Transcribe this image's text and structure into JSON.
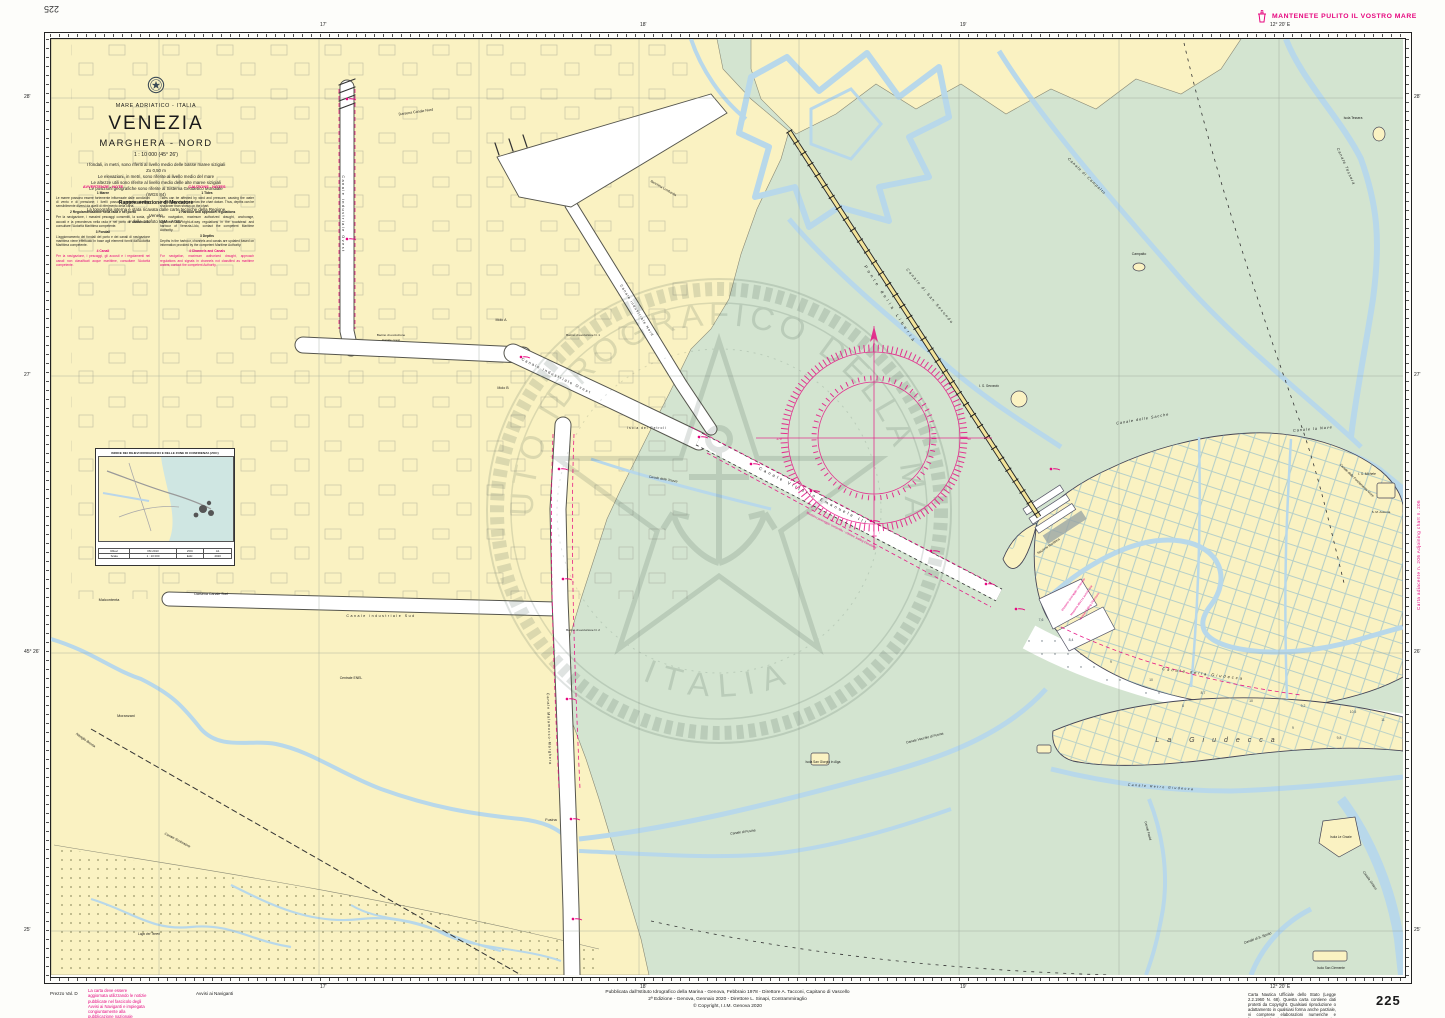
{
  "page": {
    "chart_number": "225",
    "corner_number": "225",
    "slogan": "MANTENETE PULITO IL VOSTRO MARE",
    "adjoining": "Carta adiacente n. 206        Adjoining chart n. 206",
    "bottom_left": {
      "price": "Prezzo Val. D",
      "update_note": "La carta deve essere aggiornata utilizzando le notizie pubblicate nel fascicolo degli Avvisi ai Naviganti e impiegata congiuntamente alla pubblicazione nazionale relativa.",
      "notices": "Avvisi ai Naviganti"
    },
    "bottom_center": {
      "line1": "Pubblicata dall'Istituto Idrografico della Marina - Genova, Febbraio 1978 - Direttore A. Tacconi, Capitano di Vascello",
      "line2": "2ª Edizione - Genova, Gennaio 2020 - Direttore L. Sinapi, Contrammiraglio",
      "line3": "© Copyright, I.I.M. Genova 2020"
    },
    "bottom_right_legal": "Carta Nautica Ufficiale dello Stato (Legge 2.2.1960 N. 68). Questa carta contiene dati protetti da Copyright. Qualsiasi riproduzione o adattamento in qualsiasi forma anche parziale, vi comprese elaborazioni numeriche e fotocopie, è vietata senza una preventiva autorizzazione scritta da parte dell'Istituto Idrografico della Marina.",
    "margins": {
      "top": [
        {
          "x": 320,
          "t": "17'"
        },
        {
          "x": 640,
          "t": "18'"
        },
        {
          "x": 960,
          "t": "19'"
        },
        {
          "x": 1270,
          "t": "12° 20' E"
        }
      ],
      "bottom": [
        {
          "x": 320,
          "t": "17'"
        },
        {
          "x": 640,
          "t": "18'"
        },
        {
          "x": 960,
          "t": "19'"
        },
        {
          "x": 1270,
          "t": "12° 20' E"
        }
      ],
      "left": [
        {
          "y": 97,
          "t": "28'"
        },
        {
          "y": 375,
          "t": "27'"
        },
        {
          "y": 652,
          "t": "45° 26'"
        },
        {
          "y": 930,
          "t": "25'"
        }
      ],
      "right": [
        {
          "y": 97,
          "t": "28'"
        },
        {
          "y": 375,
          "t": "27'"
        },
        {
          "y": 652,
          "t": "26'"
        },
        {
          "y": 930,
          "t": "25'"
        }
      ]
    }
  },
  "title_block": {
    "lines": [
      "MARE ADRIATICO - ITALIA",
      "VENEZIA",
      "MARGHERA - NORD",
      "1 : 10 000 (45° 26')",
      "I fondali, in metri, sono riferiti al livello medio delle basse maree sizigiali",
      "Zo 0,50 m",
      "Le elevazioni, in metri, sono riferite al livello medio del mare",
      "Le altezze utili sono riferite al livello medio delle alte maree sizigiali",
      "Le posizioni geografiche sono riferite al Sistema Geodetico Mondiale (WGS 84)",
      "Rappresentazione di Mercatore",
      "La topografia interna è stata ricavata dalle carte tecniche della Regione Veneto",
      "e dalle ortofoto IGM - AGEA"
    ]
  },
  "notes": {
    "it": {
      "header": "AVVERTENZE - NOTE",
      "s1h": "1  Maree",
      "s1b": "Le maree possono essere fortemente influenzate dalle condizioni di vento e di pressione; i livelli possono pertanto risultare sensibilmente diversi da quelli di riferimento della carta.",
      "s2h": "2  Regolamentazione nella rada e nel porto",
      "s2b": "Per la navigazione, i massimi pescaggi consentiti, la sosta, gli accosti e la precedenza nella rada e nel porto di Venezia-Lido consultare l'Autorità Marittima competente.",
      "s3h": "3  Fondali",
      "s3b": "L'aggiornamento dei fondali del porto e dei canali di navigazione marittima viene effettuato in base agli elementi forniti dall'Autorità Marittima competente.",
      "s4h": "4  Canali",
      "s4b": "Per la navigazione, i pescaggi, gli accosti e i regolamenti nei canali non classificati acque marittime, consultare l'Autorità competente."
    },
    "en": {
      "header": "CAUTIONS - NOTES",
      "s1h": "1  Tides",
      "s1b": "Tides can be affected by wind and pressure, causing the water level to stay above or below the chart datum. Thus, depths can be shallower than shown on the chart.",
      "s2h": "2  Harbour and approach regulations",
      "s2b": "For navigation, maximum authorized draught, anchorage, approach and right-of-way regulations in the roadstead and harbour of Venezia-Lido, contact the competent Maritime Authority.",
      "s3h": "3  Depths",
      "s3b": "Depths in the harbour, channels and canals are updated based on information provided by the competent Maritime Authority.",
      "s4h": "4  Channels and Canals",
      "s4b": "For navigation, maximum authorized draught, approach regulations and signals in channels not classified as maritime waters, contact the competent Authority."
    }
  },
  "inset": {
    "title": "INDICE DEI RILIEVI IDROGRAFICI E DELLE ZONE DI CONFIDENZA (ZOC)",
    "table": [
      [
        "Rilievi",
        "IIM 2013",
        "ZOC",
        "A1"
      ],
      [
        "Scala",
        "1 : 10 000",
        "Ediz.",
        "2020"
      ]
    ]
  },
  "map": {
    "colors": {
      "magenta": "#E6067E",
      "land": "#FAF2C2",
      "lagoon": "#D3E4D0",
      "water": "#B8D8EA"
    },
    "watermark": {
      "text_top": "ISTITUTO IDROGRAFICO DELLA MARINA",
      "text_bottom": "ITALIA"
    },
    "labels": [
      {
        "t": "Darsena Canale Nord",
        "x": 365,
        "y": 74,
        "s": 3.6,
        "r": -8
      },
      {
        "t": "Canale industriale Ovest",
        "x": 291,
        "y": 175,
        "s": 3.8,
        "r": 90,
        "sp": 1.5
      },
      {
        "t": "Canale industriale Ovest",
        "x": 505,
        "y": 338,
        "s": 3.8,
        "r": 26,
        "sp": 1.5
      },
      {
        "t": "Canale industriale Nord",
        "x": 585,
        "y": 272,
        "s": 3.6,
        "r": 58,
        "sp": 1
      },
      {
        "t": "Bacino di evoluzione",
        "x": 340,
        "y": 297,
        "s": 3.1
      },
      {
        "t": "Canale ovest",
        "x": 340,
        "y": 302,
        "s": 3.1
      },
      {
        "t": "Molo A",
        "x": 450,
        "y": 282,
        "s": 3.6
      },
      {
        "t": "Molo B",
        "x": 452,
        "y": 350,
        "s": 3.6
      },
      {
        "t": "Banchina Lombardia",
        "x": 612,
        "y": 150,
        "s": 3.2,
        "r": 30
      },
      {
        "t": "Darsena Canale Sud",
        "x": 160,
        "y": 556,
        "s": 3.6
      },
      {
        "t": "Canale industriale Sud",
        "x": 330,
        "y": 578,
        "s": 3.6,
        "sp": 1.5
      },
      {
        "t": "Bacino di evoluzione N. 1",
        "x": 532,
        "y": 297,
        "s": 3
      },
      {
        "t": "Bacino di evoluzione N. 2",
        "x": 532,
        "y": 592,
        "s": 3
      },
      {
        "t": "Canale Malamocco-Marghera",
        "x": 497,
        "y": 690,
        "s": 3.6,
        "r": 88,
        "sp": 1
      },
      {
        "t": "Isola dei Petroli",
        "x": 596,
        "y": 390,
        "s": 3.3,
        "sp": 1
      },
      {
        "t": "Canale delle Trezze",
        "x": 612,
        "y": 441,
        "s": 3.3,
        "r": 10,
        "i": 1
      },
      {
        "t": "Canale Vittorio Emanuele III",
        "x": 762,
        "y": 458,
        "s": 4.2,
        "r": 27,
        "sp": 2.5
      },
      {
        "t": "Massimo pescaggio consentito - vds/see Sailing Directions",
        "x": 790,
        "y": 492,
        "s": 3,
        "r": 27,
        "c": "m"
      },
      {
        "t": "Ponte della Libertà",
        "x": 838,
        "y": 266,
        "s": 4.2,
        "r": 57,
        "sp": 3
      },
      {
        "t": "Canale di San Secondo",
        "x": 878,
        "y": 258,
        "s": 3.8,
        "r": 50,
        "i": 1,
        "sp": 1.5
      },
      {
        "t": "I. S. Secondo",
        "x": 938,
        "y": 348,
        "s": 3.3,
        "i": 1
      },
      {
        "t": "Canale di Campalto",
        "x": 1035,
        "y": 138,
        "s": 3.8,
        "r": 44,
        "i": 1,
        "sp": 1
      },
      {
        "t": "Canale Tessera",
        "x": 1294,
        "y": 128,
        "s": 3.8,
        "r": 66,
        "i": 1,
        "sp": 1
      },
      {
        "t": "Isola Tessera",
        "x": 1302,
        "y": 80,
        "s": 3.2
      },
      {
        "t": "Campalto",
        "x": 1088,
        "y": 216,
        "s": 3.4
      },
      {
        "t": "Canale delle Sacche",
        "x": 1092,
        "y": 381,
        "s": 3.8,
        "r": -10,
        "i": 1,
        "sp": 1
      },
      {
        "t": "Canale la Nave",
        "x": 1262,
        "y": 391,
        "s": 3.8,
        "r": -5,
        "i": 1,
        "sp": 1
      },
      {
        "t": "Canale delle Fondamenta Nove",
        "x": 1305,
        "y": 442,
        "s": 3.3,
        "r": 44,
        "i": 1
      },
      {
        "t": "I. S. Michele",
        "x": 1316,
        "y": 436,
        "s": 3.2,
        "i": 1
      },
      {
        "t": "S. M. Assunta",
        "x": 1330,
        "y": 474,
        "s": 3
      },
      {
        "t": "Stazione Marittima",
        "x": 998,
        "y": 508,
        "s": 3.2,
        "r": -34
      },
      {
        "t": "Massimo pescaggio consentito",
        "x": 1023,
        "y": 556,
        "s": 2.9,
        "r": -55,
        "c": "m"
      },
      {
        "t": "Massima altezza autorizzata",
        "x": 1031,
        "y": 562,
        "s": 2.9,
        "r": -55,
        "c": "m"
      },
      {
        "t": "vds/see Sailing Directions",
        "x": 1039,
        "y": 568,
        "s": 2.9,
        "r": -55,
        "c": "m"
      },
      {
        "t": "Canale della Giudecca",
        "x": 1152,
        "y": 636,
        "s": 4,
        "r": 7,
        "i": 1,
        "sp": 2
      },
      {
        "t": "La Giudecca",
        "x": 1168,
        "y": 703,
        "s": 7,
        "i": 1,
        "sp": 8,
        "c": "#444"
      },
      {
        "t": "Canale Retro Giudecca",
        "x": 1110,
        "y": 749,
        "s": 3.4,
        "r": 4,
        "i": 1,
        "sp": 1.5
      },
      {
        "t": "Canale Fasiol",
        "x": 1096,
        "y": 792,
        "s": 3.2,
        "r": 75,
        "i": 1
      },
      {
        "t": "Isola Le Grazie",
        "x": 1290,
        "y": 799,
        "s": 3.2
      },
      {
        "t": "Canale Orfano",
        "x": 1318,
        "y": 842,
        "s": 3.4,
        "r": 55,
        "i": 1
      },
      {
        "t": "Canale di S. Spirito",
        "x": 1207,
        "y": 900,
        "s": 3.4,
        "r": -20,
        "i": 1
      },
      {
        "t": "Isola San Clemente",
        "x": 1280,
        "y": 930,
        "s": 3.2
      },
      {
        "t": "Isola San Giorgio in Alga",
        "x": 772,
        "y": 724,
        "s": 3.2
      },
      {
        "t": "Canale Vecchio di Fusina",
        "x": 874,
        "y": 700,
        "s": 3.4,
        "r": -14,
        "i": 1
      },
      {
        "t": "Canale di Fusina",
        "x": 692,
        "y": 794,
        "s": 3.4,
        "r": -8,
        "i": 1
      },
      {
        "t": "Fusina",
        "x": 500,
        "y": 782,
        "s": 3.8
      },
      {
        "t": "Malcontenta",
        "x": 58,
        "y": 562,
        "s": 3.8
      },
      {
        "t": "Moranzani",
        "x": 75,
        "y": 678,
        "s": 3.8
      },
      {
        "t": "Centrale ENEL",
        "x": 300,
        "y": 640,
        "s": 3.4
      },
      {
        "t": "Naviglio Brenta",
        "x": 34,
        "y": 702,
        "s": 3.4,
        "r": 35,
        "i": 1
      },
      {
        "t": "Canale Scolmatore",
        "x": 126,
        "y": 802,
        "s": 3.4,
        "r": 28,
        "i": 1
      },
      {
        "t": "Lago dei Teneri",
        "x": 98,
        "y": 896,
        "s": 3.2,
        "i": 1
      },
      {
        "t": "0",
        "x": 823,
        "y": 306,
        "s": 3,
        "c": "m"
      },
      {
        "t": "90",
        "x": 918,
        "y": 401,
        "s": 3,
        "c": "m"
      },
      {
        "t": "180",
        "x": 823,
        "y": 498,
        "s": 3,
        "c": "m"
      },
      {
        "t": "270",
        "x": 728,
        "y": 401,
        "s": 3,
        "c": "m"
      }
    ],
    "soundings": [
      {
        "x": 990,
        "y": 582,
        "v": "7,6"
      },
      {
        "x": 1020,
        "y": 602,
        "v": "8,4"
      },
      {
        "x": 1060,
        "y": 624,
        "v": "9"
      },
      {
        "x": 1100,
        "y": 642,
        "v": "10"
      },
      {
        "x": 1132,
        "y": 668,
        "v": "8"
      },
      {
        "x": 1152,
        "y": 655,
        "v": "8,7"
      },
      {
        "x": 1200,
        "y": 663,
        "v": "10"
      },
      {
        "x": 1242,
        "y": 690,
        "v": "9"
      },
      {
        "x": 1252,
        "y": 668,
        "v": "9,2"
      },
      {
        "x": 1288,
        "y": 700,
        "v": "9,8"
      },
      {
        "x": 1302,
        "y": 674,
        "v": "10,5"
      },
      {
        "x": 1332,
        "y": 682,
        "v": "11"
      }
    ],
    "lights": [
      {
        "x": 648,
        "y": 398
      },
      {
        "x": 700,
        "y": 425
      },
      {
        "x": 760,
        "y": 452
      },
      {
        "x": 820,
        "y": 482
      },
      {
        "x": 880,
        "y": 512
      },
      {
        "x": 935,
        "y": 545
      },
      {
        "x": 508,
        "y": 430
      },
      {
        "x": 512,
        "y": 540
      },
      {
        "x": 516,
        "y": 660
      },
      {
        "x": 520,
        "y": 780
      },
      {
        "x": 522,
        "y": 880
      },
      {
        "x": 965,
        "y": 570
      },
      {
        "x": 1000,
        "y": 430
      },
      {
        "x": 296,
        "y": 60
      },
      {
        "x": 296,
        "y": 200
      },
      {
        "x": 470,
        "y": 318
      }
    ]
  }
}
